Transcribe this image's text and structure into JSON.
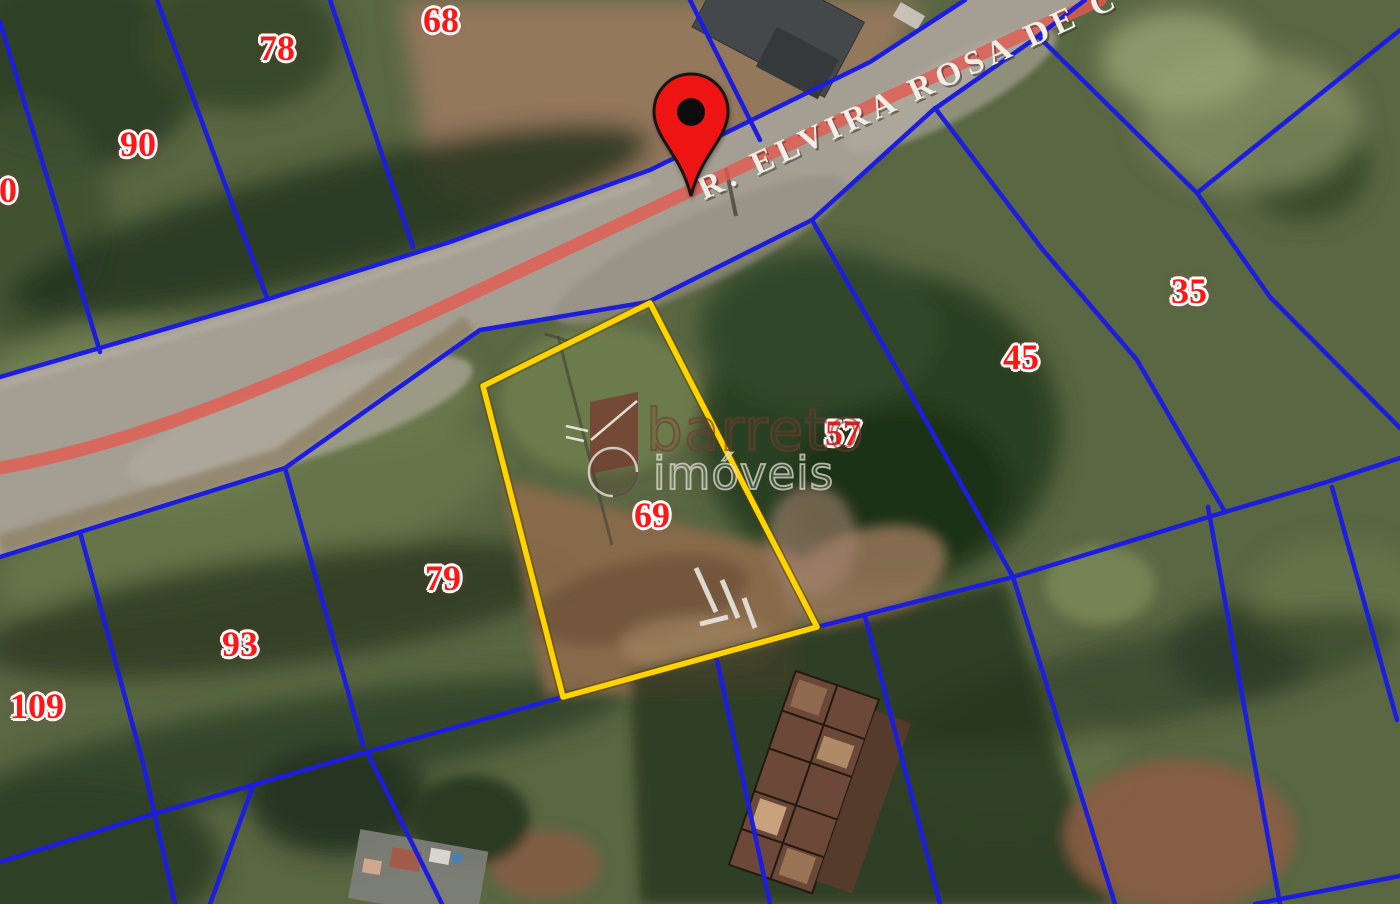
{
  "map": {
    "street": {
      "name": "R. ELVIRA ROSA DE C"
    },
    "highlighted_lot": {
      "number": "69"
    },
    "lot_labels": [
      {
        "text": "0",
        "x": 8,
        "y": 190
      },
      {
        "text": "90",
        "x": 138,
        "y": 144
      },
      {
        "text": "78",
        "x": 277,
        "y": 48
      },
      {
        "text": "68",
        "x": 441,
        "y": 20
      },
      {
        "text": "35",
        "x": 1189,
        "y": 291
      },
      {
        "text": "45",
        "x": 1021,
        "y": 357
      },
      {
        "text": "57",
        "x": 843,
        "y": 433
      },
      {
        "text": "69",
        "x": 652,
        "y": 515
      },
      {
        "text": "79",
        "x": 443,
        "y": 578
      },
      {
        "text": "93",
        "x": 240,
        "y": 644
      },
      {
        "text": "109",
        "x": 37,
        "y": 706
      }
    ]
  },
  "pin": {
    "x": 691,
    "y": 200
  },
  "watermark": {
    "brand": "barreto",
    "word": "imóveis"
  },
  "colors": {
    "boundary_blue": "#1d1ddf",
    "highlight_yellow": "#ffd400",
    "label_red": "#ff1616",
    "road_centerline_red": "#e25a50",
    "pin_red": "#ee1414"
  }
}
